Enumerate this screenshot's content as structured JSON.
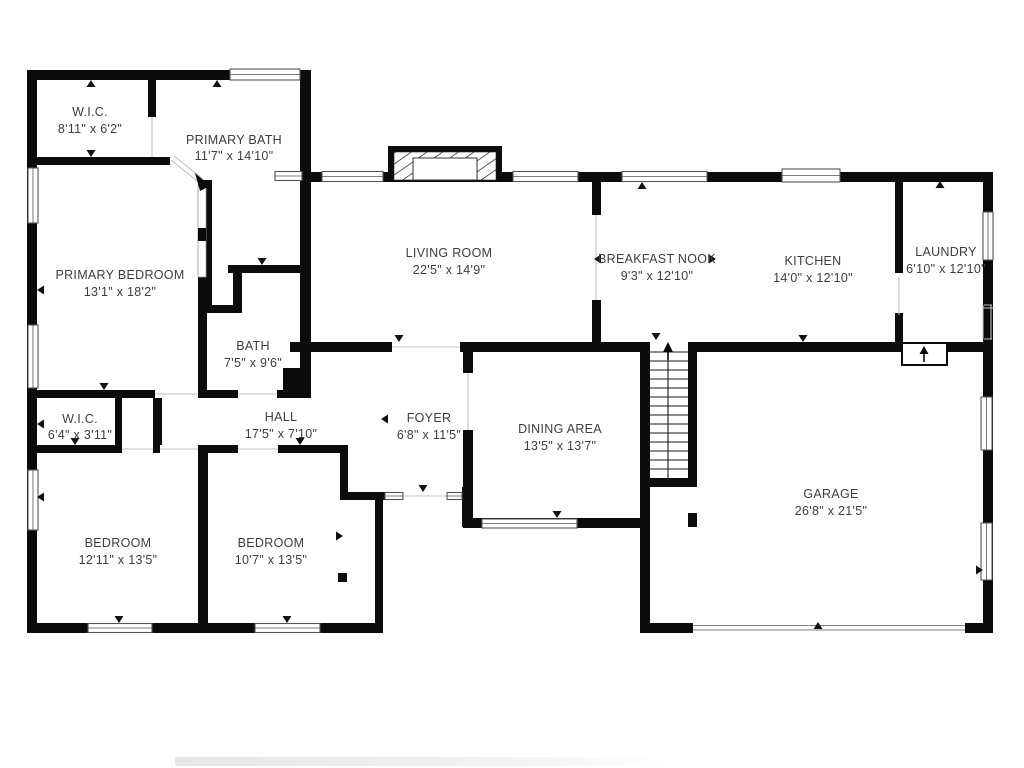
{
  "rooms": [
    {
      "id": "wic-primary",
      "name": "W.I.C.",
      "dims": "8'11\" x 6'2\""
    },
    {
      "id": "primary-bath",
      "name": "PRIMARY BATH",
      "dims": "11'7\" x 14'10\""
    },
    {
      "id": "primary-bedroom",
      "name": "PRIMARY BEDROOM",
      "dims": "13'1\" x 18'2\""
    },
    {
      "id": "living-room",
      "name": "LIVING ROOM",
      "dims": "22'5\" x 14'9\""
    },
    {
      "id": "breakfast-nook",
      "name": "BREAKFAST NOOK",
      "dims": "9'3\" x 12'10\""
    },
    {
      "id": "kitchen",
      "name": "KITCHEN",
      "dims": "14'0\" x 12'10\""
    },
    {
      "id": "laundry",
      "name": "LAUNDRY",
      "dims": "6'10\" x 12'10\""
    },
    {
      "id": "bath",
      "name": "BATH",
      "dims": "7'5\" x 9'6\""
    },
    {
      "id": "wic-hall",
      "name": "W.I.C.",
      "dims": "6'4\" x 3'11\""
    },
    {
      "id": "hall",
      "name": "HALL",
      "dims": "17'5\" x 7'10\""
    },
    {
      "id": "foyer",
      "name": "FOYER",
      "dims": "6'8\" x 11'5\""
    },
    {
      "id": "dining-area",
      "name": "DINING AREA",
      "dims": "13'5\" x 13'7\""
    },
    {
      "id": "bedroom-left",
      "name": "BEDROOM",
      "dims": "12'11\" x 13'5\""
    },
    {
      "id": "bedroom-right",
      "name": "BEDROOM",
      "dims": "10'7\" x 13'5\""
    },
    {
      "id": "garage",
      "name": "GARAGE",
      "dims": "26'8\" x 21'5\""
    }
  ],
  "icons": [
    {
      "name": "stairs-up-arrow"
    },
    {
      "name": "garage-step-up-arrow"
    },
    {
      "name": "fireplace-hatch"
    },
    {
      "name": "door-swing-diagonal"
    }
  ],
  "colors": {
    "wall": "#0b0b0b",
    "label": "#3e3e3e",
    "thin_line": "#c0c0c0",
    "window_frame": "#555555",
    "tick": "#111111",
    "footer_shadow": "#e9e9e9"
  }
}
